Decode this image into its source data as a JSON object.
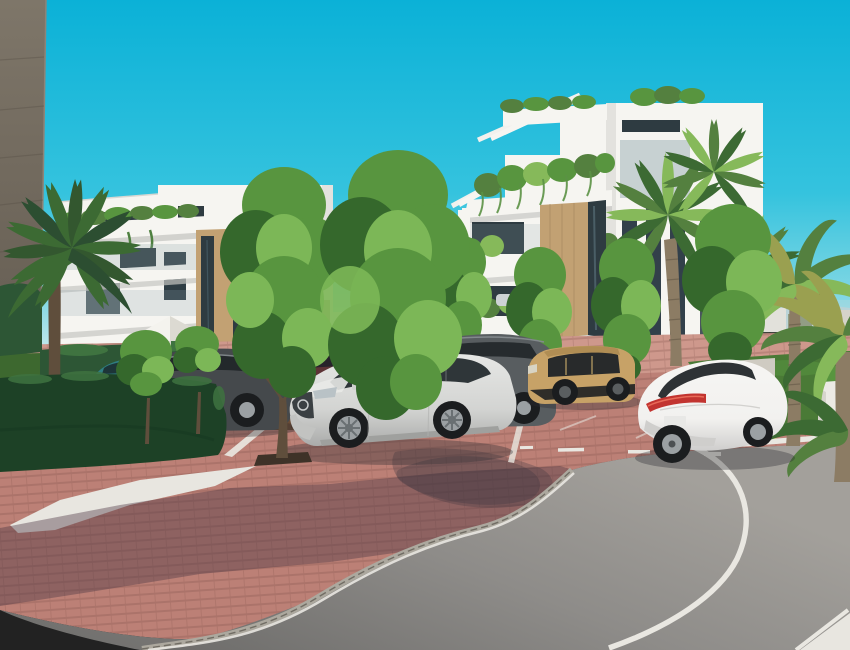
{
  "scene": {
    "type": "architectural-render",
    "description": "3D exterior rendering of a modern white residential apartment complex: two white multi-storey buildings with balconies, pergolas and hanging plants, palm trees and green landscaping, a row of parked cars (silver SUV, tan crossover, white sedan, dark cars) on reddish brick paving, and a curving asphalt access road under a bright cyan sky.",
    "time_of_day": "sunny daytime",
    "palette": {
      "sky_top": "#0bb1d7",
      "sky_mid": "#35c3de",
      "sky_horizon": "#c6eaec",
      "wall_tan": "#77705f",
      "building_white": "#f6f5f1",
      "building_shade": "#e3e2de",
      "wood_panel": "#c2a173",
      "glass_dark": "#2e3b41",
      "glass_blue": "#8fa6ad",
      "hedge_dark": "#1d4126",
      "hedge_mid": "#2d5635",
      "hedge_light": "#3f7340",
      "tree_dark": "#35682c",
      "tree_mid": "#58953f",
      "tree_light": "#7cb757",
      "palm_dark": "#3c6a33",
      "palm_mid": "#54803f",
      "palm_light": "#86b95a",
      "palm_yellow": "#9aa050",
      "trunk": "#8c7c64",
      "trunk_dark": "#5f4e3c",
      "brick": "#bc8076",
      "brick_light": "#cf9a8f",
      "gravel": "#e8e6e0",
      "grass": "#4a7a36",
      "lawn_dark": "#3d682f",
      "fence_dark": "#3e433d",
      "city_white": "#e9e5dd",
      "city_red": "#9b5a4e",
      "mountain": "#bfcfd2",
      "line_white": "#e9e7e1",
      "curb": "#aca89e",
      "asphalt_dark": "#6c6b69",
      "asphalt_light": "#a3a09b",
      "car_silver": "#d3d4d2",
      "car_white": "#f2f1ef",
      "car_tan": "#c7a267",
      "car_grey": "#585d60",
      "car_dark": "#45494c",
      "car_teal": "#2f7e82",
      "car_red": "#8f3c38",
      "taillight": "#c23430",
      "tire": "#1b1d1f",
      "rim": "#9ba0a3",
      "gate_wood": "#6b4c36",
      "planter_white": "#eceae4"
    },
    "objects": [
      "sky",
      "distant-mountains",
      "distant-skyline",
      "privacy-fence",
      "side-wall",
      "apartment-building-left",
      "apartment-building-right",
      "roof-pergola",
      "hanging-plants",
      "palm-trees",
      "deciduous-trees",
      "boxwood-hedges",
      "lawn",
      "garden-umbrella",
      "sun-loungers",
      "wooden-gate",
      "brick-paving",
      "parking-lines",
      "asphalt-road",
      "road-edge-line",
      "curb",
      "white-gravel",
      "grass-verge",
      "white-planter",
      "parked-teal-car",
      "parked-dark-sedan",
      "parked-red-car",
      "parked-grey-suv",
      "silver-suv",
      "tan-crossover-suv",
      "white-sedan",
      "distant-cars"
    ]
  }
}
